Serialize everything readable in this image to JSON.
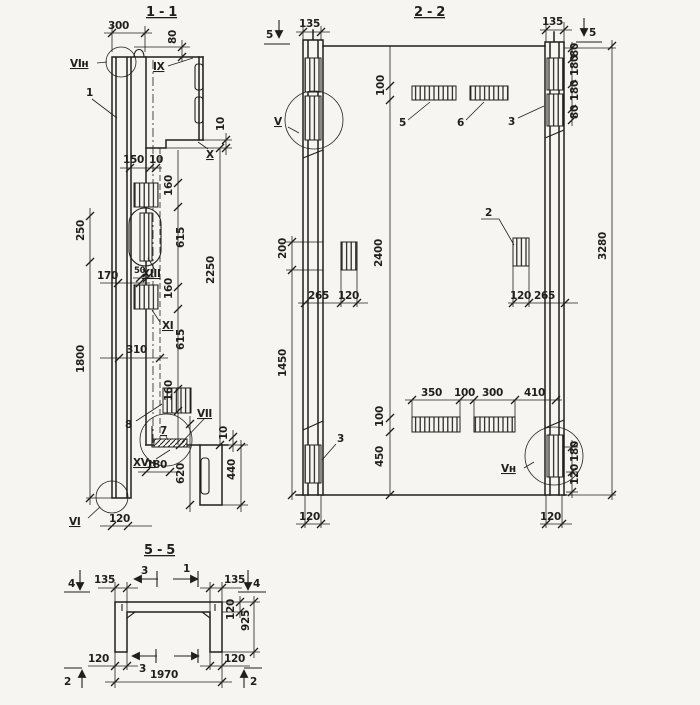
{
  "page": {
    "paper": "#f7f5f1",
    "ink": "#211f1c"
  },
  "s11": {
    "title": "1 - 1",
    "t": {
      "d300": "300",
      "d80": "80",
      "vin": "VIн",
      "n1": "1",
      "ix": "IX",
      "d10a": "10",
      "x": "X",
      "d150": "150",
      "d10b": "10",
      "d160a": "160",
      "d615a": "615",
      "xiii": "XIII",
      "d170": "170",
      "d50": "50",
      "d250": "250",
      "d160b": "160",
      "xi": "XI",
      "d615b": "615",
      "d310": "310",
      "d1800": "1800",
      "d2250": "2250",
      "n8": "8",
      "d160c": "160",
      "n7": "7",
      "vii": "VII",
      "d10r": "10",
      "xvn": "XVн",
      "d180": "180",
      "d620": "620",
      "d440": "440",
      "vi": "VI",
      "d120": "120"
    }
  },
  "s22": {
    "title": "2 - 2",
    "t": {
      "cut5l": "5",
      "d135l": "135",
      "v": "V",
      "d100t": "100",
      "n5": "5",
      "n6": "6",
      "n3t": "3",
      "d135r": "135",
      "cut5r": "5",
      "d80a": "80",
      "d180a": "180",
      "d180b": "180",
      "d80b": "80",
      "d3280": "3280",
      "d200": "200",
      "d1450": "1450",
      "d265a": "265",
      "d120a": "120",
      "d2400": "2400",
      "n2": "2",
      "d120b": "120",
      "d265b": "265",
      "d350": "350",
      "d100m": "100",
      "d300": "300",
      "d410": "410",
      "d100b": "100",
      "n3b": "3",
      "d450": "450",
      "vn": "Vн",
      "d180r": "180",
      "d120r": "120",
      "d120bl": "120",
      "d120br": "120"
    }
  },
  "s55": {
    "title": "5 - 5",
    "t": {
      "m4l": "4",
      "d135l": "135",
      "m3t": "3",
      "m1": "1",
      "d135r": "135",
      "m4r": "4",
      "d120slab": "120",
      "d925": "925",
      "d120wl": "120",
      "m3b": "3",
      "d1970": "1970",
      "d120wr": "120",
      "m2l": "2",
      "m2r": "2"
    }
  }
}
